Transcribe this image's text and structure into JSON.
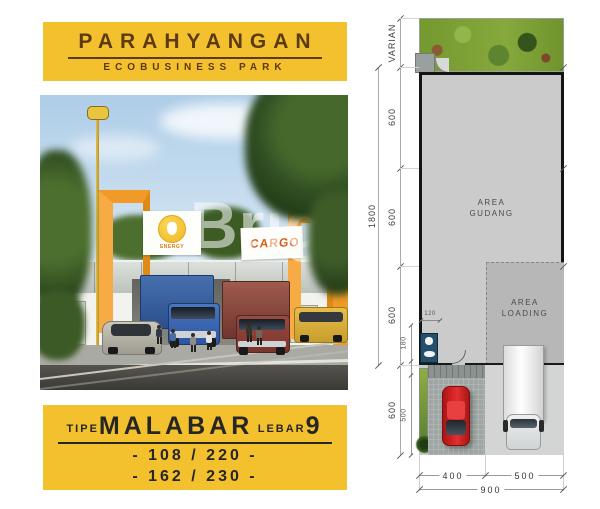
{
  "header": {
    "title": "PARAHYANGAN",
    "subtitle": "ECOBUSINESS PARK"
  },
  "render": {
    "watermark": "Bright",
    "cargo_sign": "CARGO",
    "energy_sign": "ENERGY"
  },
  "footer": {
    "tipe_label": "TIPE",
    "type_name": "MALABAR",
    "lebar_label": "LEBAR",
    "lebar_value": "9",
    "spec_line1": "- 108 / 220 -",
    "spec_line2": "- 162 / 230 -"
  },
  "plan": {
    "areas": {
      "gudang": [
        "AREA",
        "GUDANG"
      ],
      "loading": [
        "AREA",
        "LOADING"
      ]
    },
    "dims": {
      "total_depth": "1800",
      "left_segments": [
        "VARIAN",
        "600",
        "600",
        "600",
        "600"
      ],
      "detail_width": "120",
      "detail_heights": [
        "180",
        "500"
      ],
      "bottom_segments": [
        "400",
        "500"
      ],
      "bottom_total": "900"
    }
  },
  "colors": {
    "brand_yellow": "#F4C12E",
    "brand_brown": "#5C3A14",
    "accent_orange": "#F09A28",
    "cargo_orange": "#D85C1A",
    "plan_gray": "#CBCBCB",
    "loading_gray": "#B7B7B7",
    "grass_green": "#74992F",
    "car_red": "#C81E1E",
    "truck_blue": "#30579E",
    "truck_maroon": "#8A4036",
    "bathroom_blue": "#24506B"
  }
}
